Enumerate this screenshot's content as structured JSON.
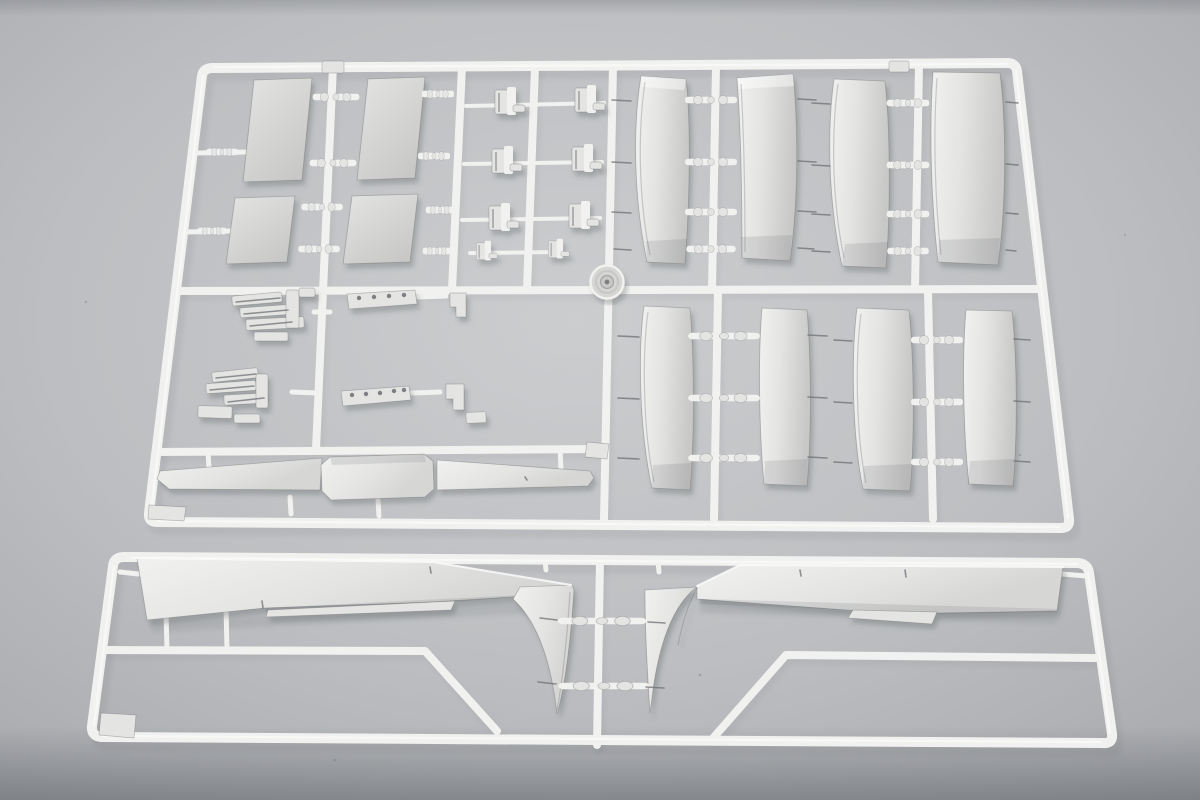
{
  "meta": {
    "title": "Photograph of two light-gray injection-molded model-kit sprues on a neutral gray backdrop"
  },
  "colors": {
    "bg_center": "#cbcdcf",
    "bg_mid": "#bcbec1",
    "bg_edge": "#a6a8ac",
    "plastic_bright": "#f1f1ef",
    "plastic_light": "#e4e4e2",
    "plastic_mid": "#d6d6d4",
    "plastic_dim": "#c8c8c6",
    "plastic_shadow": "rgba(75,79,84,0.30)",
    "edge_line": "rgba(110,112,115,0.45)",
    "pin_dark": "#6e7074",
    "hole_dark": "#7d7f82"
  },
  "scene": {
    "upper_sprue": {
      "label": "upper parts frame",
      "part_counts": {
        "rectangular_panels": 4,
        "small_clamp_brackets": 8,
        "stepped_bracket_clusters": 2,
        "perforated_strips": 2,
        "curved_slat_panels": 8,
        "spar_sections": 3,
        "round_disc": 1
      }
    },
    "lower_sprue": {
      "label": "lower wing frame",
      "part_counts": {
        "wing_halves": 2,
        "flap_strips": 2
      }
    }
  }
}
